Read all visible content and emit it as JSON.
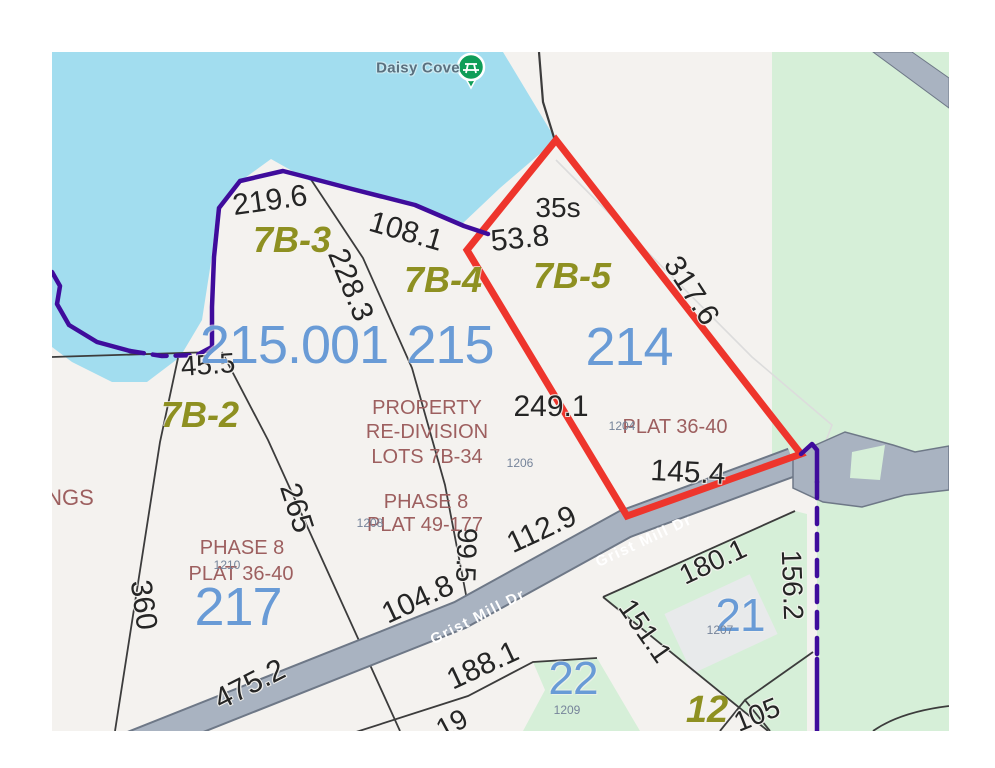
{
  "title": "Plat map – Daisy Cove / Grist Mill Dr parcels",
  "poi": {
    "label": "Daisy Cove"
  },
  "roads": {
    "name": "Grist Mill Dr"
  },
  "colors": {
    "land": "#f4f2ef",
    "lake": "#a2ddef",
    "green_area": "#d6efd8",
    "road_fill": "#a9b3c1",
    "road_edge": "#6e7887",
    "highlight_red": "#ee352c",
    "boundary_purple": "#3f0c9c",
    "parcelblue": "#699bd6",
    "olive": "#8e9021",
    "maroon": "#9d5f5f",
    "pin_green": "#0f9d58"
  },
  "labels": [
    {
      "id": "poi-daisy-cove",
      "cls": "poi",
      "text": "Daisy Cove",
      "x": 366,
      "y": 16,
      "rot": 0,
      "fs": 15
    },
    {
      "id": "dim-219-6",
      "cls": "dim",
      "text": "219.6",
      "x": 218,
      "y": 149,
      "rot": -8,
      "fs": 30
    },
    {
      "id": "dim-108-1",
      "cls": "dim",
      "text": "108.1",
      "x": 354,
      "y": 180,
      "rot": 16,
      "fs": 30
    },
    {
      "id": "dim-228-3",
      "cls": "dim",
      "text": "228.3",
      "x": 298,
      "y": 233,
      "rot": 68,
      "fs": 30
    },
    {
      "id": "dim-35s",
      "cls": "dim",
      "text": "35s",
      "x": 506,
      "y": 156,
      "rot": 0,
      "fs": 28
    },
    {
      "id": "dim-53-8",
      "cls": "dim",
      "text": "53.8",
      "x": 468,
      "y": 187,
      "rot": -6,
      "fs": 30
    },
    {
      "id": "dim-317-6",
      "cls": "dim",
      "text": "317.6",
      "x": 639,
      "y": 239,
      "rot": 57,
      "fs": 30
    },
    {
      "id": "dim-45-5",
      "cls": "dim",
      "text": "45.5",
      "x": 156,
      "y": 313,
      "rot": -4,
      "fs": 28
    },
    {
      "id": "dim-249-1",
      "cls": "dim",
      "text": "249.1",
      "x": 499,
      "y": 355,
      "rot": 0,
      "fs": 30
    },
    {
      "id": "dim-145-4",
      "cls": "dim",
      "text": "145.4",
      "x": 636,
      "y": 421,
      "rot": 3,
      "fs": 30
    },
    {
      "id": "dim-99-5",
      "cls": "dim",
      "text": "99.5",
      "x": 414,
      "y": 503,
      "rot": 92,
      "fs": 28
    },
    {
      "id": "dim-112-9",
      "cls": "dim",
      "text": "112.9",
      "x": 490,
      "y": 478,
      "rot": -25,
      "fs": 30
    },
    {
      "id": "dim-104-8",
      "cls": "dim",
      "text": "104.8",
      "x": 366,
      "y": 548,
      "rot": -25,
      "fs": 30
    },
    {
      "id": "dim-475-2",
      "cls": "dim",
      "text": "475.2",
      "x": 198,
      "y": 633,
      "rot": -27,
      "fs": 30
    },
    {
      "id": "dim-188-1",
      "cls": "dim",
      "text": "188.1",
      "x": 431,
      "y": 614,
      "rot": -25,
      "fs": 30
    },
    {
      "id": "dim-360",
      "cls": "dim",
      "text": "360",
      "x": 91,
      "y": 553,
      "rot": 82,
      "fs": 30
    },
    {
      "id": "dim-265",
      "cls": "dim",
      "text": "265",
      "x": 244,
      "y": 456,
      "rot": 72,
      "fs": 30
    },
    {
      "id": "dim-180-1",
      "cls": "dim",
      "text": "180.1",
      "x": 661,
      "y": 510,
      "rot": -25,
      "fs": 28
    },
    {
      "id": "dim-151-1",
      "cls": "dim",
      "text": "151.1",
      "x": 593,
      "y": 579,
      "rot": 55,
      "fs": 28
    },
    {
      "id": "dim-156-2",
      "cls": "dim",
      "text": "156.2",
      "x": 740,
      "y": 533,
      "rot": 88,
      "fs": 28
    },
    {
      "id": "dim-105",
      "cls": "dim",
      "text": "105",
      "x": 705,
      "y": 663,
      "rot": -22,
      "fs": 28
    },
    {
      "id": "dim-19-clipped",
      "cls": "dim",
      "text": "19",
      "x": 400,
      "y": 672,
      "rot": -28,
      "fs": 28
    },
    {
      "id": "lot-7b-3",
      "cls": "lot",
      "text": "7B-3",
      "x": 240,
      "y": 188,
      "rot": 0,
      "fs": 36
    },
    {
      "id": "lot-7b-4",
      "cls": "lot",
      "text": "7B-4",
      "x": 391,
      "y": 228,
      "rot": 0,
      "fs": 36
    },
    {
      "id": "lot-7b-5",
      "cls": "lot",
      "text": "7B-5",
      "x": 520,
      "y": 224,
      "rot": 0,
      "fs": 36
    },
    {
      "id": "lot-7b-2",
      "cls": "lot",
      "text": "7B-2",
      "x": 148,
      "y": 363,
      "rot": 0,
      "fs": 36
    },
    {
      "id": "lot-12",
      "cls": "lot",
      "text": "12",
      "x": 655,
      "y": 658,
      "rot": 0,
      "fs": 38
    },
    {
      "id": "parcel-215-001",
      "cls": "parcel",
      "text": "215.001",
      "x": 242,
      "y": 293,
      "rot": 0,
      "fs": 54
    },
    {
      "id": "parcel-215",
      "cls": "parcel",
      "text": "215",
      "x": 398,
      "y": 293,
      "rot": 0,
      "fs": 54
    },
    {
      "id": "parcel-214",
      "cls": "parcel",
      "text": "214",
      "x": 577,
      "y": 295,
      "rot": 0,
      "fs": 54
    },
    {
      "id": "parcel-217",
      "cls": "parcel",
      "text": "217",
      "x": 186,
      "y": 555,
      "rot": 0,
      "fs": 54
    },
    {
      "id": "parcel-22",
      "cls": "parcel",
      "text": "22",
      "x": 521,
      "y": 626,
      "rot": 0,
      "fs": 46
    },
    {
      "id": "parcel-21",
      "cls": "parcel",
      "text": "21",
      "x": 688,
      "y": 563,
      "rot": 0,
      "fs": 46
    },
    {
      "id": "plat-property",
      "cls": "plat",
      "text": "PROPERTY",
      "x": 375,
      "y": 356,
      "rot": 0,
      "fs": 20
    },
    {
      "id": "plat-re-division",
      "cls": "plat",
      "text": "RE-DIVISION",
      "x": 375,
      "y": 380,
      "rot": 0,
      "fs": 20
    },
    {
      "id": "plat-lots-7b-34",
      "cls": "plat",
      "text": "LOTS 7B-34",
      "x": 375,
      "y": 405,
      "rot": 0,
      "fs": 20
    },
    {
      "id": "plat-phase-8-215",
      "cls": "plat",
      "text": "PHASE 8",
      "x": 374,
      "y": 450,
      "rot": 0,
      "fs": 20
    },
    {
      "id": "plat-49-177",
      "cls": "plat",
      "text": "PLAT 49-177",
      "x": 373,
      "y": 473,
      "rot": 0,
      "fs": 20
    },
    {
      "id": "plat-phase-8-217",
      "cls": "plat",
      "text": "PHASE 8",
      "x": 190,
      "y": 496,
      "rot": 0,
      "fs": 20
    },
    {
      "id": "plat-36-40-217",
      "cls": "plat",
      "text": "PLAT 36-40",
      "x": 189,
      "y": 522,
      "rot": 0,
      "fs": 20
    },
    {
      "id": "plat-36-40-214",
      "cls": "plat",
      "text": "PLAT 36-40",
      "x": 623,
      "y": 375,
      "rot": 0,
      "fs": 20
    },
    {
      "id": "plat-ngs",
      "cls": "plat",
      "text": "NGS",
      "x": 18,
      "y": 446,
      "rot": 0,
      "fs": 22
    },
    {
      "id": "addr-1206",
      "cls": "addr",
      "text": "1206",
      "x": 468,
      "y": 411,
      "rot": 0,
      "fs": 12
    },
    {
      "id": "addr-1208",
      "cls": "addr",
      "text": "1208",
      "x": 318,
      "y": 471,
      "rot": 0,
      "fs": 12
    },
    {
      "id": "addr-1210",
      "cls": "addr",
      "text": "1210",
      "x": 175,
      "y": 513,
      "rot": 0,
      "fs": 12
    },
    {
      "id": "addr-1204",
      "cls": "addr",
      "text": "1204",
      "x": 570,
      "y": 374,
      "rot": 0,
      "fs": 12
    },
    {
      "id": "addr-1207",
      "cls": "addr",
      "text": "1207",
      "x": 668,
      "y": 578,
      "rot": 0,
      "fs": 12
    },
    {
      "id": "addr-1209",
      "cls": "addr",
      "text": "1209",
      "x": 515,
      "y": 658,
      "rot": 0,
      "fs": 12
    },
    {
      "id": "road-grist-mill-dr-1",
      "cls": "road",
      "text": "Grist Mill Dr",
      "x": 426,
      "y": 565,
      "rot": -27,
      "fs": 15
    },
    {
      "id": "road-grist-mill-dr-2",
      "cls": "road",
      "text": "Grist Mill Dr",
      "x": 592,
      "y": 489,
      "rot": -25,
      "fs": 15
    }
  ]
}
